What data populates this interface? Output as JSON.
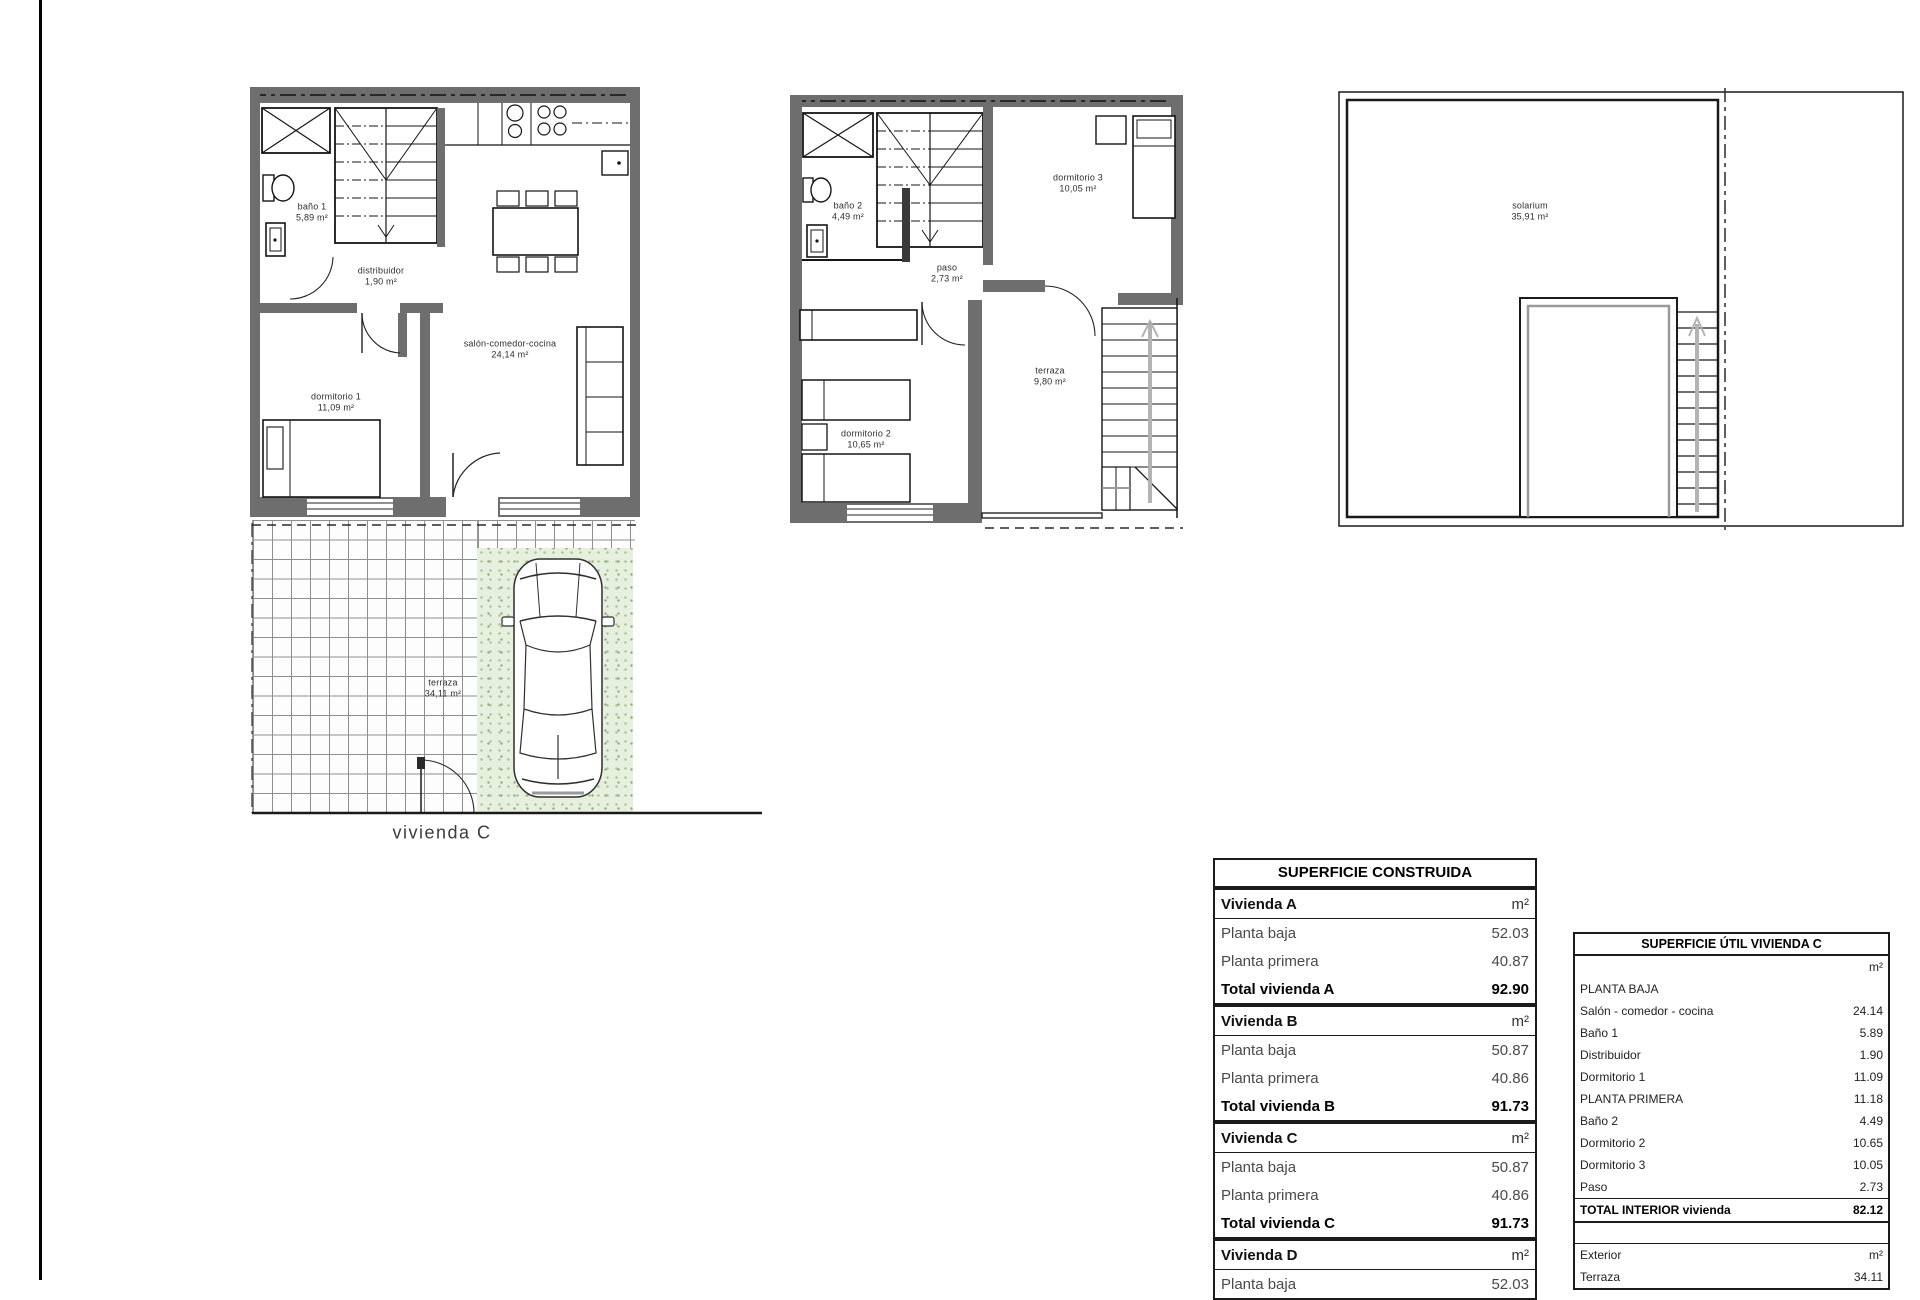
{
  "plans": {
    "planta_baja": {
      "caption": "vivienda C",
      "rooms": [
        {
          "name": "baño 1",
          "area": "5,89 m²"
        },
        {
          "name": "distribuidor",
          "area": "1,90 m²"
        },
        {
          "name": "salón-comedor-cocina",
          "area": "24,14 m²"
        },
        {
          "name": "dormitorio 1",
          "area": "11,09 m²"
        },
        {
          "name": "terraza",
          "area": "34,11 m²"
        }
      ]
    },
    "planta_primera": {
      "rooms": [
        {
          "name": "baño 2",
          "area": "4,49 m²"
        },
        {
          "name": "paso",
          "area": "2,73 m²"
        },
        {
          "name": "dormitorio 3",
          "area": "10,05 m²"
        },
        {
          "name": "dormitorio 2",
          "area": "10,65 m²"
        },
        {
          "name": "terraza",
          "area": "9,80 m²"
        }
      ]
    },
    "solarium": {
      "rooms": [
        {
          "name": "solarium",
          "area": "35,91 m²"
        }
      ]
    }
  },
  "tables": {
    "construida": {
      "title": "SUPERFICIE CONSTRUIDA",
      "rows": [
        {
          "label": "Vivienda A",
          "value": "m²"
        },
        {
          "label": "Planta baja",
          "value": "52.03"
        },
        {
          "label": "Planta primera",
          "value": "40.87"
        },
        {
          "label": "Total vivienda A",
          "value": "92.90"
        },
        {
          "label": "Vivienda B",
          "value": "m²"
        },
        {
          "label": "Planta baja",
          "value": "50.87"
        },
        {
          "label": "Planta primera",
          "value": "40.86"
        },
        {
          "label": "Total vivienda B",
          "value": "91.73"
        },
        {
          "label": "Vivienda C",
          "value": "m²"
        },
        {
          "label": "Planta baja",
          "value": "50.87"
        },
        {
          "label": "Planta primera",
          "value": "40.86"
        },
        {
          "label": "Total vivienda C",
          "value": "91.73"
        },
        {
          "label": "Vivienda D",
          "value": "m²"
        },
        {
          "label": "Planta baja",
          "value": "52.03"
        }
      ]
    },
    "util_c": {
      "title": "SUPERFICIE ÚTIL VIVIENDA C",
      "rows": [
        {
          "label": "",
          "value": "m²"
        },
        {
          "label": "PLANTA BAJA",
          "value": ""
        },
        {
          "label": "Salón - comedor - cocina",
          "value": "24.14"
        },
        {
          "label": "Baño 1",
          "value": "5.89"
        },
        {
          "label": "Distribuidor",
          "value": "1.90"
        },
        {
          "label": "Dormitorio 1",
          "value": "11.09"
        },
        {
          "label": "PLANTA PRIMERA",
          "value": "11.18"
        },
        {
          "label": "Baño 2",
          "value": "4.49"
        },
        {
          "label": "Dormitorio 2",
          "value": "10.65"
        },
        {
          "label": "Dormitorio 3",
          "value": "10.05"
        },
        {
          "label": "Paso",
          "value": "2.73"
        },
        {
          "label": "TOTAL INTERIOR vivienda",
          "value": "82.12"
        },
        {
          "label": "",
          "value": ""
        },
        {
          "label": "Exterior",
          "value": "m²"
        },
        {
          "label": "Terraza",
          "value": "34.11"
        }
      ]
    }
  }
}
